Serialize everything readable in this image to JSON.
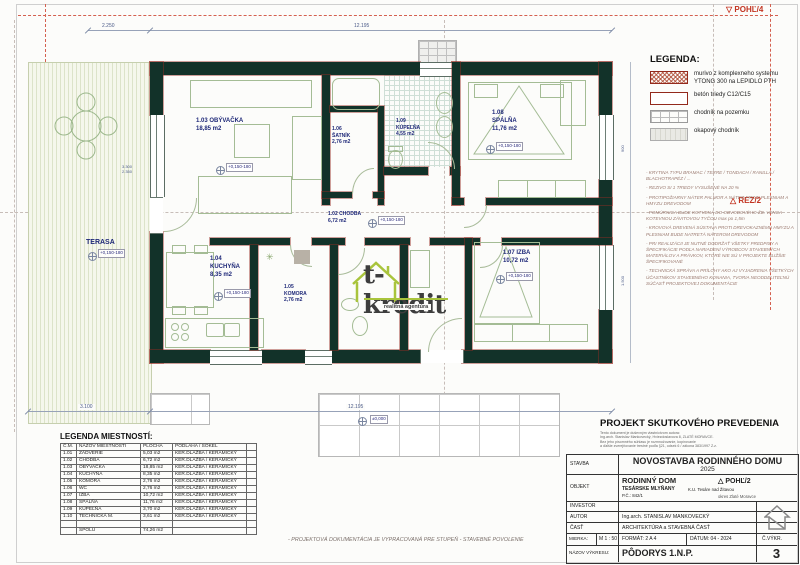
{
  "plan": {
    "elev": "+0,150-180",
    "ground": "±0,000",
    "terasa": {
      "name": "TERASA"
    },
    "rooms": {
      "obyvacka": {
        "id": "1.03",
        "name": "OBÝVAČKA",
        "area": "18,85 m2"
      },
      "satnik": {
        "id": "1.06",
        "name": "ŠATNÍK",
        "area": "2,76 m2"
      },
      "kupelna": {
        "id": "1.09",
        "name": "KÚPEĽŇA",
        "area": "4,55 m2"
      },
      "spalna": {
        "id": "1.08",
        "name": "SPÁLŇA",
        "area": "11,76 m2"
      },
      "chodba": {
        "id": "1.02",
        "name": "CHODBA",
        "area": "6,72 m2"
      },
      "kuchyna": {
        "id": "1.04",
        "name": "KUCHYŇA",
        "area": "8,35 m2"
      },
      "komora": {
        "id": "1.05",
        "name": "KOMORA",
        "area": "2,76 m2"
      },
      "izba": {
        "id": "1.07",
        "name": "IZBA",
        "area": "10,72 m2"
      }
    },
    "dims": {
      "top_left": "2.250",
      "top": "12.195",
      "bottom_left": "3.100",
      "bottom": "12.195",
      "win_a": "3.300",
      "win_b": "2.350",
      "win_c": "900",
      "win_d": "1.500"
    },
    "markers": {
      "pohl4_icon": "▽",
      "pohl4": "POHĽ/4",
      "rez2_icon": "△",
      "rez2": "REZ/2"
    }
  },
  "watermark": {
    "brand": "t-kredit",
    "tagline": "realitná agentúra"
  },
  "legend": {
    "title": "LEGENDA:",
    "items": [
      {
        "name": "ytong",
        "label": "murivo z komplexneho systemu YTONG 300 na LEPIDLO PTH"
      },
      {
        "name": "beton",
        "label": "betón triedy C12/C15"
      },
      {
        "name": "chodnik",
        "label": "chodník na pozemku"
      },
      {
        "name": "okap",
        "label": "okapový chodník"
      }
    ]
  },
  "notes": [
    "- KRYTINA TYPU BRAMAC / TERRE / TONDACH / RANILLA / BLACHOTRAPÉZ / ...",
    "- REZIVO SI 1 TRIEDY VYSUŠENÉ NA 20 %",
    "- PROTIPOŽIARNY NÁTER PALMOR A NÁTER PROTI PLESNIAM A HMYZU DREVODOM",
    "- POMÚRNICA BUDE KOTVENÁ DO OBVODOVÉHO ŽB. VENCA KOTEVNOU ZÁVITOVOU TYČOU max po 1,5m",
    "- KROVOVÁ DREVENÁ SÚSTAVA PROTI DREVOKAZNÉMU HMYZU A PLESNIAM BUDE NATRETÁ NÁTEROM DREVODOM",
    "- PRI REALIZÁCII JE NUTNÉ DODRŽAŤ VŠETKY PREDPISY A ŠPECIFIKÁCIE PODĽA NARIADENÍ VÝROBCOV STAVEBNÝCH MATERIÁLOV A PRÁVKOV, KTORÉ NIE SÚ V PROJEKTE BLIŽŠIE ŠPECIFIKOVANÉ",
    "- TECHNICKÁ SPRÁVA A PRÍLOHY AKO AJ VYJADRENIA VŠETKÝCH ÚČASTNÍKOV STAVEBNÉHO KONANIA, TVORIA NEODDELITEĽNÚ SÚČASŤ PROJEKTOVEJ DOKUMENTÁCIE"
  ],
  "room_table": {
    "title": "LEGENDA MIESTNOSTÍ:",
    "headers": [
      "Č.M.",
      "NÁZOV MIESTNOSTI",
      "PLOCHA",
      "PODLAHA / SOKEL"
    ],
    "rows": [
      [
        "1.01",
        "ZÁDVERIE",
        "5,03 m2",
        "KER.DLAŽBA / KERAMICKÝ"
      ],
      [
        "1.02",
        "CHODBA",
        "6,72 m2",
        "KER.DLAŽBA / KERAMICKÝ"
      ],
      [
        "1.03",
        "OBÝVAČKA",
        "18,85 m2",
        "KER.DLAŽBA / KERAMICKÝ"
      ],
      [
        "1.04",
        "KUCHYŇA",
        "8,35 m2",
        "KER.DLAŽBA / KERAMICKÝ"
      ],
      [
        "1.05",
        "KOMORA",
        "2,76 m2",
        "KER.DLAŽBA / KERAMICKÝ"
      ],
      [
        "1.06",
        "WC",
        "2,76 m2",
        "KER.DLAŽBA / KERAMICKÝ"
      ],
      [
        "1.07",
        "IZBA",
        "10,72 m2",
        "KER.DLAŽBA / KERAMICKÝ"
      ],
      [
        "1.08",
        "SPÁLŇA",
        "11,76 m2",
        "KER.DLAŽBA / KERAMICKÝ"
      ],
      [
        "1.09",
        "KÚPEĽŇA",
        "3,70 m2",
        "KER.DLAŽBA / KERAMICKÝ"
      ],
      [
        "1.10",
        "TECHNICKÁ M.",
        "3,61 m2",
        "KER.DLAŽBA / KERAMICKÝ"
      ]
    ],
    "total_label": "SPOLU",
    "total_value": "74,26 m2"
  },
  "footer_note": "- PROJEKTOVÁ DOKUMENTÁCIA JE VYPRACOVANÁ PRE STUPEŇ - STAVEBNÉ POVOLENIE",
  "title_block": {
    "header": "PROJEKT SKUTKOVÉHO PREVEDENIA",
    "copyright": [
      "Tento dokument je duševným vlastníctvom autora:",
      "Ing.arch. Stanislav Mankovecký, Hviezdoslavova 8, ZLATÉ MORAVCE.",
      "Bez jeho písomného súhlasu je rozmnožovanie, kopírovanie",
      "a ďalšie zverejňovanie trestné podľa §21, odsek 6 / zákona 383/1997 Z.z."
    ],
    "stavba_label": "STAVBA",
    "stavba": "NOVOSTAVBA RODINNÉHO DOMU",
    "rok": "2025",
    "objekt_label": "OBJEKT",
    "objekt": "RODINNÝ DOM",
    "objekt_marker_icon": "△",
    "objekt_marker": "POHĽ/2",
    "obec": "TESÁRSKE MLYŇANY",
    "ku": "K.U. Tesáre nad Žitavou",
    "parcela": "P.Č.: 842/1",
    "okres": "okres Zlaté Moravce",
    "investor_label": "INVESTOR",
    "autor_label": "AUTOR",
    "autor": "Ing.arch. STANISLAV MANKOVECKÝ",
    "cast_label": "ČASŤ",
    "cast": "ARCHITEKTÚRA a STAVEBNÁ ČASŤ",
    "mierka_label": "MIERKA:",
    "mierka": "M 1 : 50",
    "format": "FORMÁT: 2 A 4",
    "datum": "DÁTUM: 04 - 2024",
    "cvykr_label": "Č.VÝKR.",
    "cvykr": "3",
    "nazov_label": "NÁZOV VÝKRESU:",
    "nazov": "PÔDORYS 1.N.P."
  }
}
